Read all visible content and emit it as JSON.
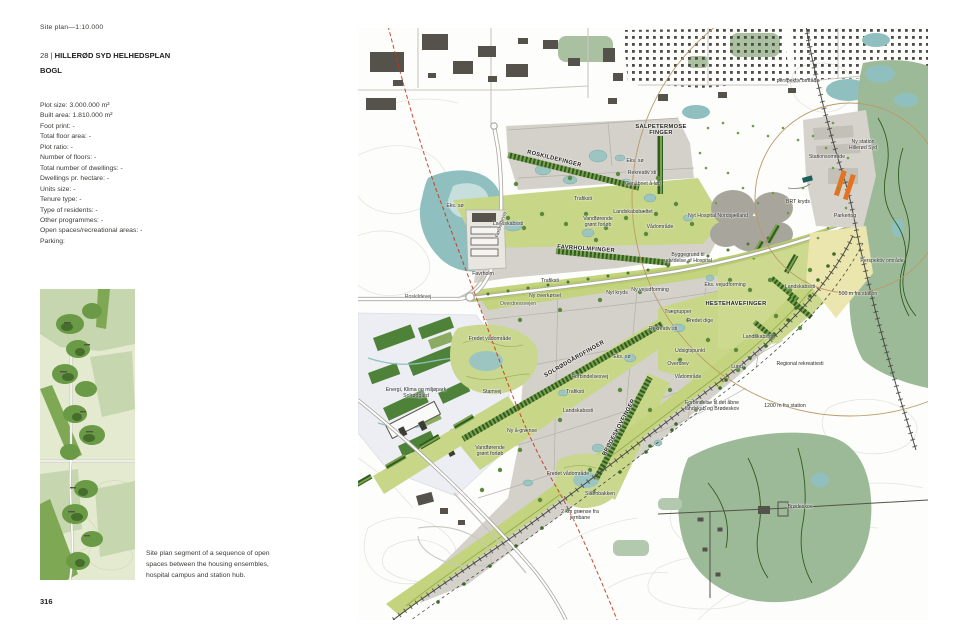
{
  "page": {
    "scale_note": "Site plan—1:10.000",
    "project_prefix": "28 | ",
    "project_title": "HILLERØD SYD HELHEDSPLAN",
    "architect": "BOGL",
    "page_number": "316",
    "caption": "Site plan segment of a sequence of open spaces between the housing ensembles, hospital campus and station hub."
  },
  "facts": [
    "Plot size: 3.000.000 m²",
    "Built area: 1.810.000 m²",
    "Foot print: -",
    "Total floor area: -",
    "Plot ratio: -",
    "Number of floors: -",
    "Total number of dwellings: -",
    "Dwellings pr. hectare: -",
    "Units size: -",
    "Tenure type: -",
    "Type of residents: -",
    "Other programmes: -",
    "Open spaces/recreational areas: -",
    "Parking:"
  ],
  "colors": {
    "corridor_green": "#c8d687",
    "plot_grey": "#d4d1ca",
    "forest_sage": "#9dba98",
    "lake_teal": "#8fc0bf",
    "tree_dark_green": "#3c682a",
    "station_orange": "#e4731f",
    "red_dashed_line": "#c0371b",
    "radius_arc_tan": "#bb9a68",
    "parking_yellow": "#ebe6ae"
  },
  "map": {
    "labels": [
      {
        "t": "ROSKILDEFINGER",
        "x": 196,
        "y": 132,
        "r": 14,
        "c": "finger"
      },
      {
        "t": "SALPETERMOSE\nFINGER",
        "x": 303,
        "y": 103,
        "c": "finger"
      },
      {
        "t": "FAVRHOLMFINGER",
        "x": 228,
        "y": 222,
        "r": 4,
        "c": "finger"
      },
      {
        "t": "SOLRØDGÅRDFINGER",
        "x": 217,
        "y": 332,
        "r": -30,
        "c": "finger"
      },
      {
        "t": "BRØDESKOVFINGER",
        "x": 262,
        "y": 400,
        "r": -62,
        "c": "finger"
      },
      {
        "t": "HESTEHAVEFINGER",
        "x": 378,
        "y": 277,
        "c": "finger"
      },
      {
        "t": "Eks. sø",
        "x": 277,
        "y": 134
      },
      {
        "t": "Rekreativ sti",
        "x": 284,
        "y": 146
      },
      {
        "t": "Genåbnet å-løb",
        "x": 285,
        "y": 157
      },
      {
        "t": "Trafiksti",
        "x": 225,
        "y": 172
      },
      {
        "t": "Landskabsbæltet",
        "x": 275,
        "y": 185
      },
      {
        "t": "Vandførende\ngrønt forløb",
        "x": 240,
        "y": 195
      },
      {
        "t": "Vådområde",
        "x": 302,
        "y": 200
      },
      {
        "t": "Nyt Hospital Nordsjælland",
        "x": 360,
        "y": 189
      },
      {
        "t": "Byggegrund til\nudvidelse af Hospital",
        "x": 330,
        "y": 231
      },
      {
        "t": "Landskabssti",
        "x": 150,
        "y": 197
      },
      {
        "t": "Eks. sø",
        "x": 97,
        "y": 179
      },
      {
        "t": "Roskildevej",
        "x": 144,
        "y": 197,
        "r": -72,
        "c": "road"
      },
      {
        "t": "Roskildevej",
        "x": 60,
        "y": 270,
        "c": "road"
      },
      {
        "t": "Favrholm",
        "x": 125,
        "y": 247
      },
      {
        "t": "Overdrevsvejen",
        "x": 160,
        "y": 277,
        "c": "road"
      },
      {
        "t": "Fredet vådområde",
        "x": 132,
        "y": 312
      },
      {
        "t": "Stationsområde",
        "x": 469,
        "y": 130
      },
      {
        "t": "Ny station\nHillerød Syd",
        "x": 505,
        "y": 118
      },
      {
        "t": "BRT kryds",
        "x": 440,
        "y": 175
      },
      {
        "t": "Parkering",
        "x": 487,
        "y": 189
      },
      {
        "t": "Perspektiv område",
        "x": 524,
        "y": 234
      },
      {
        "t": "perspektiv område",
        "x": 440,
        "y": 54
      },
      {
        "t": "Nyt kryds",
        "x": 259,
        "y": 266
      },
      {
        "t": "Ny vejudforming",
        "x": 292,
        "y": 263
      },
      {
        "t": "Eks. vejudforming",
        "x": 367,
        "y": 258
      },
      {
        "t": "Ny overkørsel",
        "x": 187,
        "y": 269
      },
      {
        "t": "Trafiksti",
        "x": 192,
        "y": 254
      },
      {
        "t": "Trægrupper",
        "x": 320,
        "y": 285
      },
      {
        "t": "Rekreativ sti",
        "x": 305,
        "y": 302
      },
      {
        "t": "Fredet dige",
        "x": 342,
        "y": 294
      },
      {
        "t": "Landskabssti",
        "x": 442,
        "y": 260
      },
      {
        "t": "Landskabssti",
        "x": 400,
        "y": 310
      },
      {
        "t": "500 m fra station",
        "x": 500,
        "y": 267
      },
      {
        "t": "Regional rekreativsti",
        "x": 442,
        "y": 337
      },
      {
        "t": "1200 m fra station",
        "x": 427,
        "y": 379
      },
      {
        "t": "Forbindelse til det åbne\nlandskab og Brødeskov",
        "x": 354,
        "y": 379
      },
      {
        "t": "Eks. sø",
        "x": 264,
        "y": 330
      },
      {
        "t": "Udsigtspunkt",
        "x": 332,
        "y": 324
      },
      {
        "t": "Overdrev",
        "x": 320,
        "y": 337
      },
      {
        "t": "Vådområde",
        "x": 330,
        "y": 350
      },
      {
        "t": "Forbindelsesvej",
        "x": 232,
        "y": 350
      },
      {
        "t": "Trafiksti",
        "x": 217,
        "y": 365
      },
      {
        "t": "Landskabssti",
        "x": 220,
        "y": 384
      },
      {
        "t": "Stamvej",
        "x": 134,
        "y": 365
      },
      {
        "t": "Ny å-grænse",
        "x": 164,
        "y": 404
      },
      {
        "t": "Vandførende\ngrønt forløb",
        "x": 132,
        "y": 424
      },
      {
        "t": "Energi, Klima og miljøpark\nSolrødgård",
        "x": 58,
        "y": 366
      },
      {
        "t": "Fredet vådområde",
        "x": 210,
        "y": 447
      },
      {
        "t": "Slåenbakken",
        "x": 242,
        "y": 467
      },
      {
        "t": "2 km grænse fra\njernbane",
        "x": 222,
        "y": 488
      },
      {
        "t": "Brødeskov",
        "x": 442,
        "y": 480
      },
      {
        "t": "Lund",
        "x": 379,
        "y": 340
      }
    ]
  }
}
